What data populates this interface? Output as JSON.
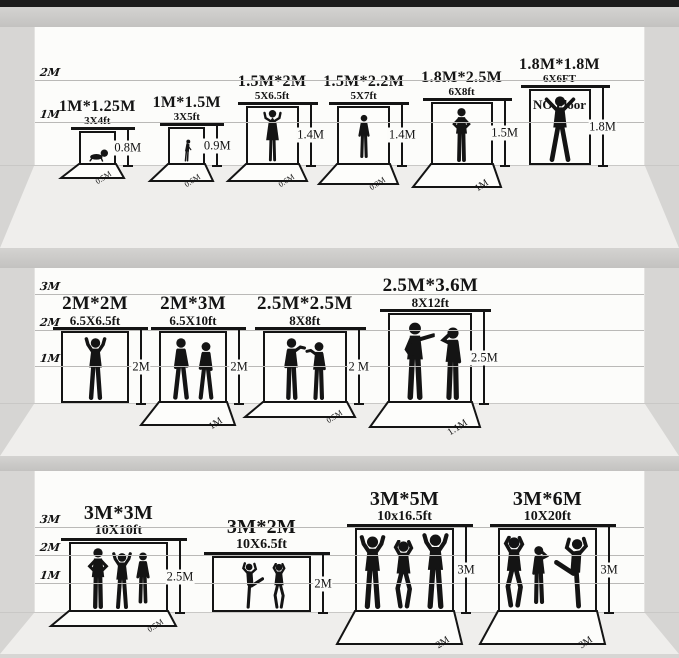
{
  "description": "Photography backdrop size comparison chart, three studio rooms with silhouettes for scale",
  "colors": {
    "ink": "#141414",
    "wall": "#fcfcfa",
    "top_bar": "#1c1c1c",
    "divider_band": "#c8c7c5",
    "floor_center": "#efeeec",
    "floor_side": "#d6d5d3",
    "gridline": "#bab9b7"
  },
  "panels": [
    {
      "scale_labels": [
        "2M",
        "1M"
      ],
      "backdrops": [
        {
          "title": "1M*1.25M",
          "subtitle": "3X4ft",
          "height_label": "0.8M",
          "floor_label": "0.5M",
          "figures": [
            {
              "pose": "baby"
            }
          ]
        },
        {
          "title": "1M*1.5M",
          "subtitle": "3X5ft",
          "height_label": "0.9M",
          "floor_label": "0.6M",
          "figures": [
            {
              "pose": "child"
            }
          ]
        },
        {
          "title": "1.5M*2M",
          "subtitle": "5X6.5ft",
          "height_label": "1.4M",
          "floor_label": "0.6M",
          "figures": [
            {
              "pose": "dress"
            }
          ]
        },
        {
          "title": "1.5M*2.2M",
          "subtitle": "5X7ft",
          "height_label": "1.4M",
          "floor_label": "0.8M",
          "figures": [
            {
              "pose": "stand"
            }
          ]
        },
        {
          "title": "1.8M*2.5M",
          "subtitle": "6X8ft",
          "height_label": "1.5M",
          "floor_label": "1M",
          "figures": [
            {
              "pose": "hips"
            }
          ]
        },
        {
          "title": "1.8M*1.8M",
          "subtitle": "6X6FT",
          "height_label": "1.8M",
          "floor_label": null,
          "no_floor_label": "NO Floor",
          "figures": [
            {
              "pose": "spread"
            }
          ]
        }
      ]
    },
    {
      "scale_labels": [
        "3M",
        "2M",
        "1M"
      ],
      "backdrops": [
        {
          "title": "2M*2M",
          "subtitle": "6.5X6.5ft",
          "height_label": "2M",
          "floor_label": null,
          "figures": [
            {
              "pose": "armsup"
            }
          ]
        },
        {
          "title": "2M*3M",
          "subtitle": "6.5X10ft",
          "height_label": "2M",
          "floor_label": "1M",
          "figures": [
            {
              "pose": "walk"
            },
            {
              "pose": "walk",
              "flip": true
            }
          ]
        },
        {
          "title": "2.5M*2.5M",
          "subtitle": "8X8ft",
          "height_label": "2 M",
          "floor_label": "0.5M",
          "figures": [
            {
              "pose": "talk"
            },
            {
              "pose": "talk",
              "flip": true
            }
          ]
        },
        {
          "title": "2.5M*3.6M",
          "subtitle": "8X12ft",
          "height_label": "2.5M",
          "floor_label": "1.1M",
          "figures": [
            {
              "pose": "point"
            },
            {
              "pose": "drink",
              "flip": true
            }
          ]
        }
      ]
    },
    {
      "scale_labels": [
        "3M",
        "2M",
        "1M"
      ],
      "backdrops": [
        {
          "title": "3M*3M",
          "subtitle": "10X10ft",
          "height_label": "2.5M",
          "floor_label": "0.5M",
          "figures": [
            {
              "pose": "hips"
            },
            {
              "pose": "armsup"
            },
            {
              "pose": "stand"
            }
          ]
        },
        {
          "title": "3M*2M",
          "subtitle": "10X6.5ft",
          "height_label": "2M",
          "floor_label": null,
          "figures": [
            {
              "pose": "kick"
            },
            {
              "pose": "dance"
            }
          ]
        },
        {
          "title": "3M*5M",
          "subtitle": "10x16.5ft",
          "height_label": "3M",
          "floor_label": "2M",
          "figures": [
            {
              "pose": "armsup"
            },
            {
              "pose": "dance"
            },
            {
              "pose": "armsup"
            }
          ]
        },
        {
          "title": "3M*6M",
          "subtitle": "10X20ft",
          "height_label": "3M",
          "floor_label": "3M",
          "figures": [
            {
              "pose": "dance"
            },
            {
              "pose": "drink"
            },
            {
              "pose": "kick",
              "flip": true
            }
          ]
        }
      ]
    }
  ]
}
